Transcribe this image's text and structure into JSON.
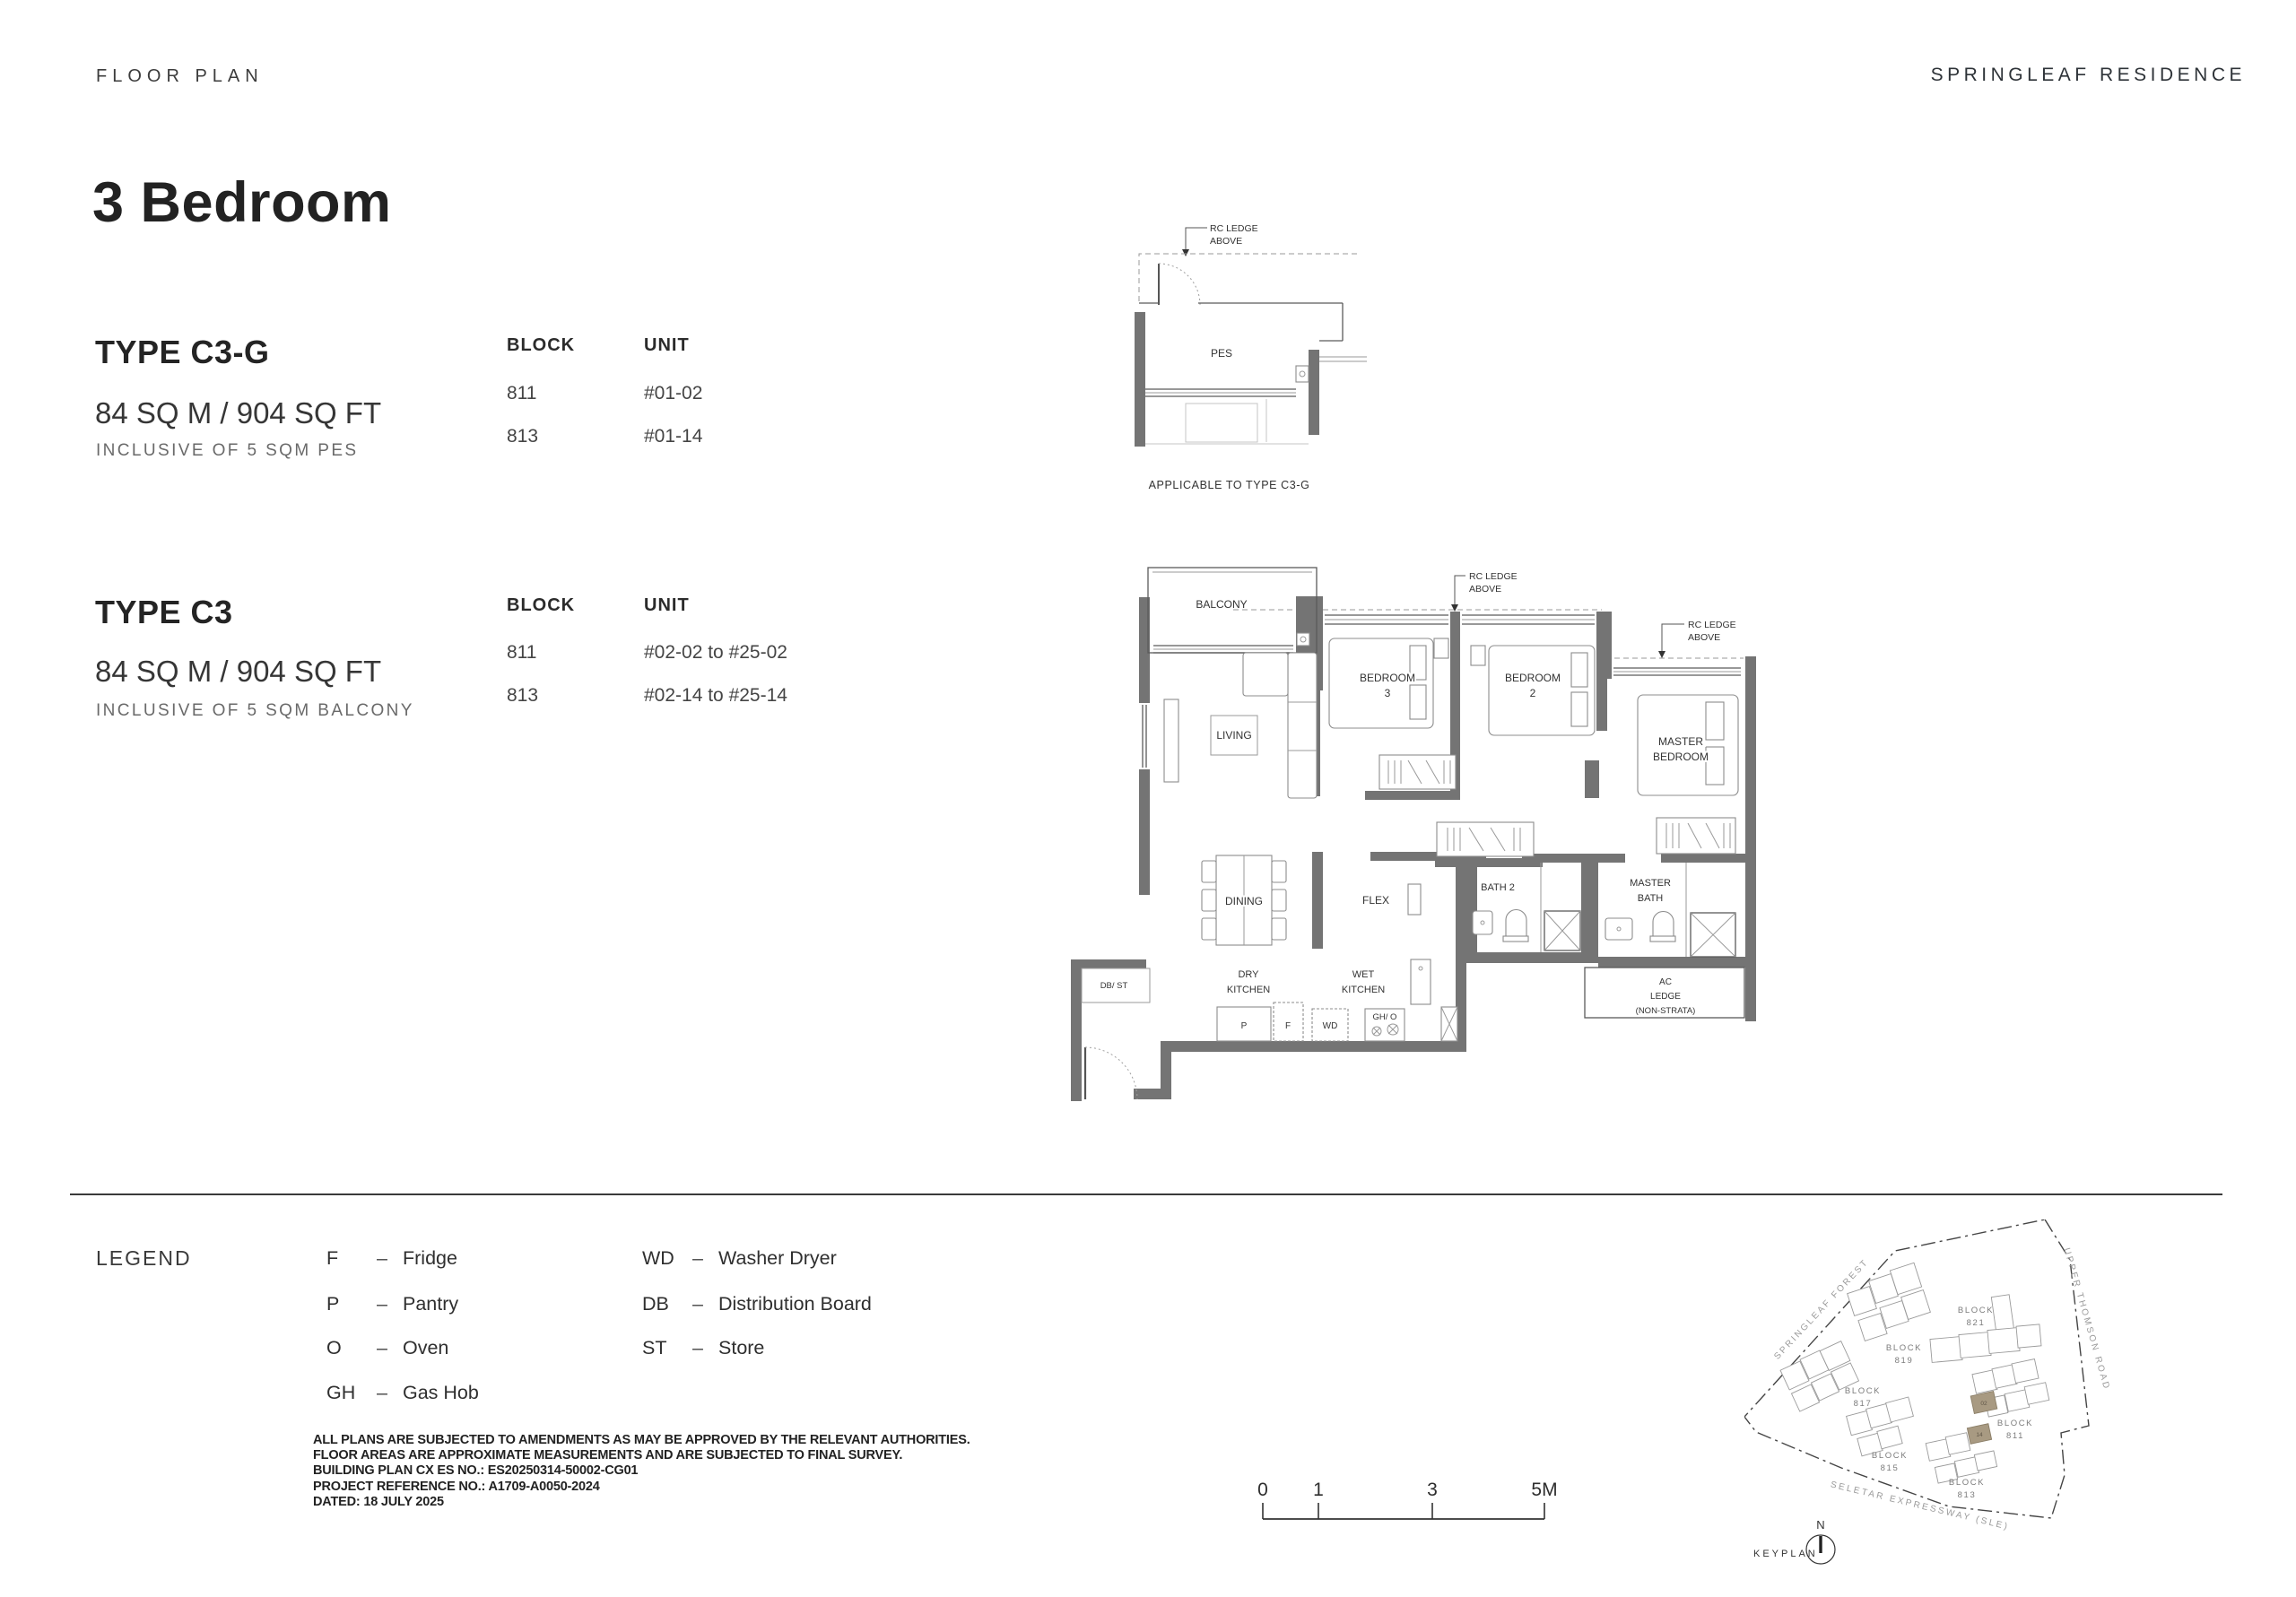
{
  "header": {
    "left": "FLOOR PLAN",
    "right": "SPRINGLEAF RESIDENCE"
  },
  "page_title": "3 Bedroom",
  "types": [
    {
      "name": "TYPE C3-G",
      "area": "84 SQ M / 904 SQ FT",
      "inclusive": "INCLUSIVE OF 5 SQM PES",
      "block_header": "BLOCK",
      "unit_header": "UNIT",
      "rows": [
        {
          "block": "811",
          "unit": "#01-02"
        },
        {
          "block": "813",
          "unit": "#01-14"
        }
      ]
    },
    {
      "name": "TYPE C3",
      "area": "84 SQ M / 904 SQ FT",
      "inclusive": "INCLUSIVE OF 5 SQM BALCONY",
      "block_header": "BLOCK",
      "unit_header": "UNIT",
      "rows": [
        {
          "block": "811",
          "unit": "#02-02 to #25-02"
        },
        {
          "block": "813",
          "unit": "#02-14 to #25-14"
        }
      ]
    }
  ],
  "small_plan": {
    "rc_ledge": [
      "RC LEDGE",
      "ABOVE"
    ],
    "room": "PES",
    "caption": "APPLICABLE TO TYPE C3-G"
  },
  "main_plan": {
    "rc_ledge_1": [
      "RC LEDGE",
      "ABOVE"
    ],
    "rc_ledge_2": [
      "RC LEDGE",
      "ABOVE"
    ],
    "rooms": {
      "balcony": "BALCONY",
      "living": "LIVING",
      "bedroom3": [
        "BEDROOM",
        "3"
      ],
      "bedroom2": [
        "BEDROOM",
        "2"
      ],
      "master_bedroom": [
        "MASTER",
        "BEDROOM"
      ],
      "dining": "DINING",
      "flex": "FLEX",
      "bath2": "BATH 2",
      "master_bath": [
        "MASTER",
        "BATH"
      ],
      "dry_kitchen": [
        "DRY",
        "KITCHEN"
      ],
      "wet_kitchen": [
        "WET",
        "KITCHEN"
      ],
      "db_st": "DB/ ST",
      "ac_ledge": [
        "AC",
        "LEDGE",
        "(NON-STRATA)"
      ]
    },
    "appliances": {
      "pantry": "P",
      "fridge": "F",
      "washer": "WD",
      "gas": "GH/ O"
    }
  },
  "legend": {
    "label": "LEGEND",
    "separator": "–",
    "col1": [
      {
        "key": "F",
        "label": "Fridge"
      },
      {
        "key": "P",
        "label": "Pantry"
      },
      {
        "key": "O",
        "label": "Oven"
      },
      {
        "key": "GH",
        "label": "Gas Hob"
      }
    ],
    "col2": [
      {
        "key": "WD",
        "label": "Washer Dryer"
      },
      {
        "key": "DB",
        "label": "Distribution Board"
      },
      {
        "key": "ST",
        "label": "Store"
      }
    ]
  },
  "disclaimer": {
    "lines": [
      "ALL PLANS ARE SUBJECTED TO AMENDMENTS AS MAY BE APPROVED BY THE RELEVANT AUTHORITIES.",
      "FLOOR AREAS ARE APPROXIMATE MEASUREMENTS AND ARE SUBJECTED TO FINAL SURVEY.",
      "BUILDING PLAN CX ES NO.: ES20250314-50002-CG01",
      "PROJECT REFERENCE NO.: A1709-A0050-2024",
      "DATED: 18 JULY 2025"
    ]
  },
  "scale_bar": {
    "ticks": [
      "0",
      "1",
      "3",
      "5M"
    ]
  },
  "keyplan": {
    "label": "KEYPLAN",
    "north": "N",
    "roads": [
      "SPRINGLEAF FOREST",
      "UPPER THOMSON ROAD",
      "SELETAR EXPRESSWAY (SLE)"
    ],
    "blocks": [
      {
        "word": "BLOCK",
        "num": "819"
      },
      {
        "word": "BLOCK",
        "num": "821"
      },
      {
        "word": "BLOCK",
        "num": "817"
      },
      {
        "word": "BLOCK",
        "num": "815"
      },
      {
        "word": "BLOCK",
        "num": "811"
      },
      {
        "word": "BLOCK",
        "num": "813"
      }
    ],
    "highlighted_units": [
      "02",
      "14"
    ],
    "highlight_color": "#a89a82"
  },
  "colors": {
    "wall": "#747474",
    "rule": "#3a3a3a"
  }
}
